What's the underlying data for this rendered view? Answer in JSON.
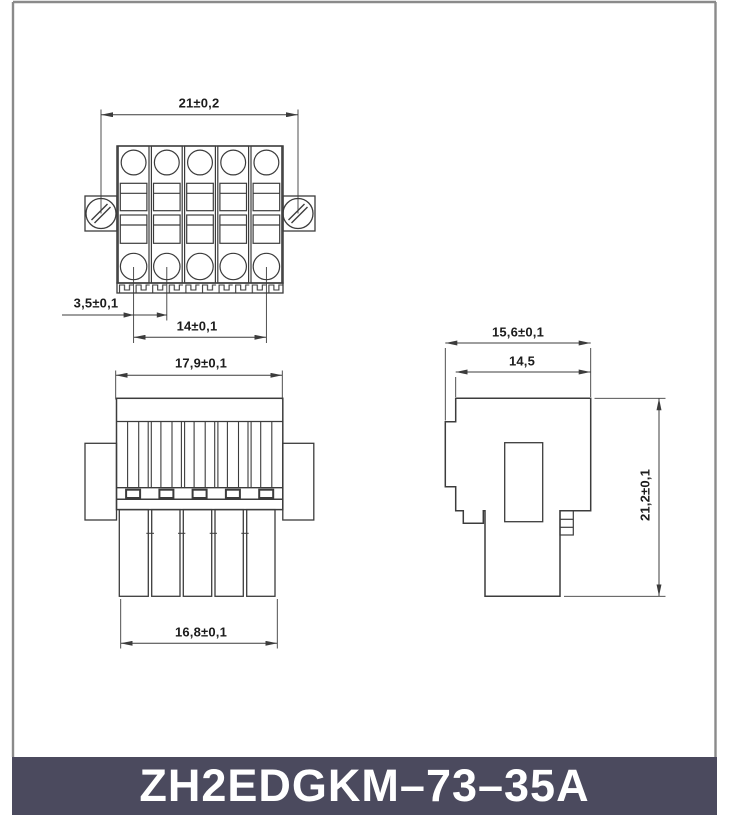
{
  "product": {
    "model": "ZH2EDGKM–73–35A",
    "positions": 5
  },
  "title_bar": {
    "bg_color": "#4b4a5e",
    "text_color": "#ffffff"
  },
  "drawing": {
    "line_color": "#3c3c3c",
    "frame_color": "#8a8a8a",
    "background": "#ffffff",
    "views": {
      "top_view": {
        "name": "front face view with mounting flanges",
        "dims": {
          "overall_width": "21±0,2",
          "pitch": "3,5±0,1",
          "pin_span": "14±0,1"
        }
      },
      "front_view": {
        "name": "plug body view with solder legs",
        "dims": {
          "body_width": "17,9±0,1",
          "leg_row_width": "16,8±0,1"
        }
      },
      "side_view": {
        "name": "side profile view",
        "dims": {
          "overall_depth": "15,6±0,1",
          "body_depth": "14,5",
          "overall_height": "21,2±0,1"
        }
      }
    }
  }
}
